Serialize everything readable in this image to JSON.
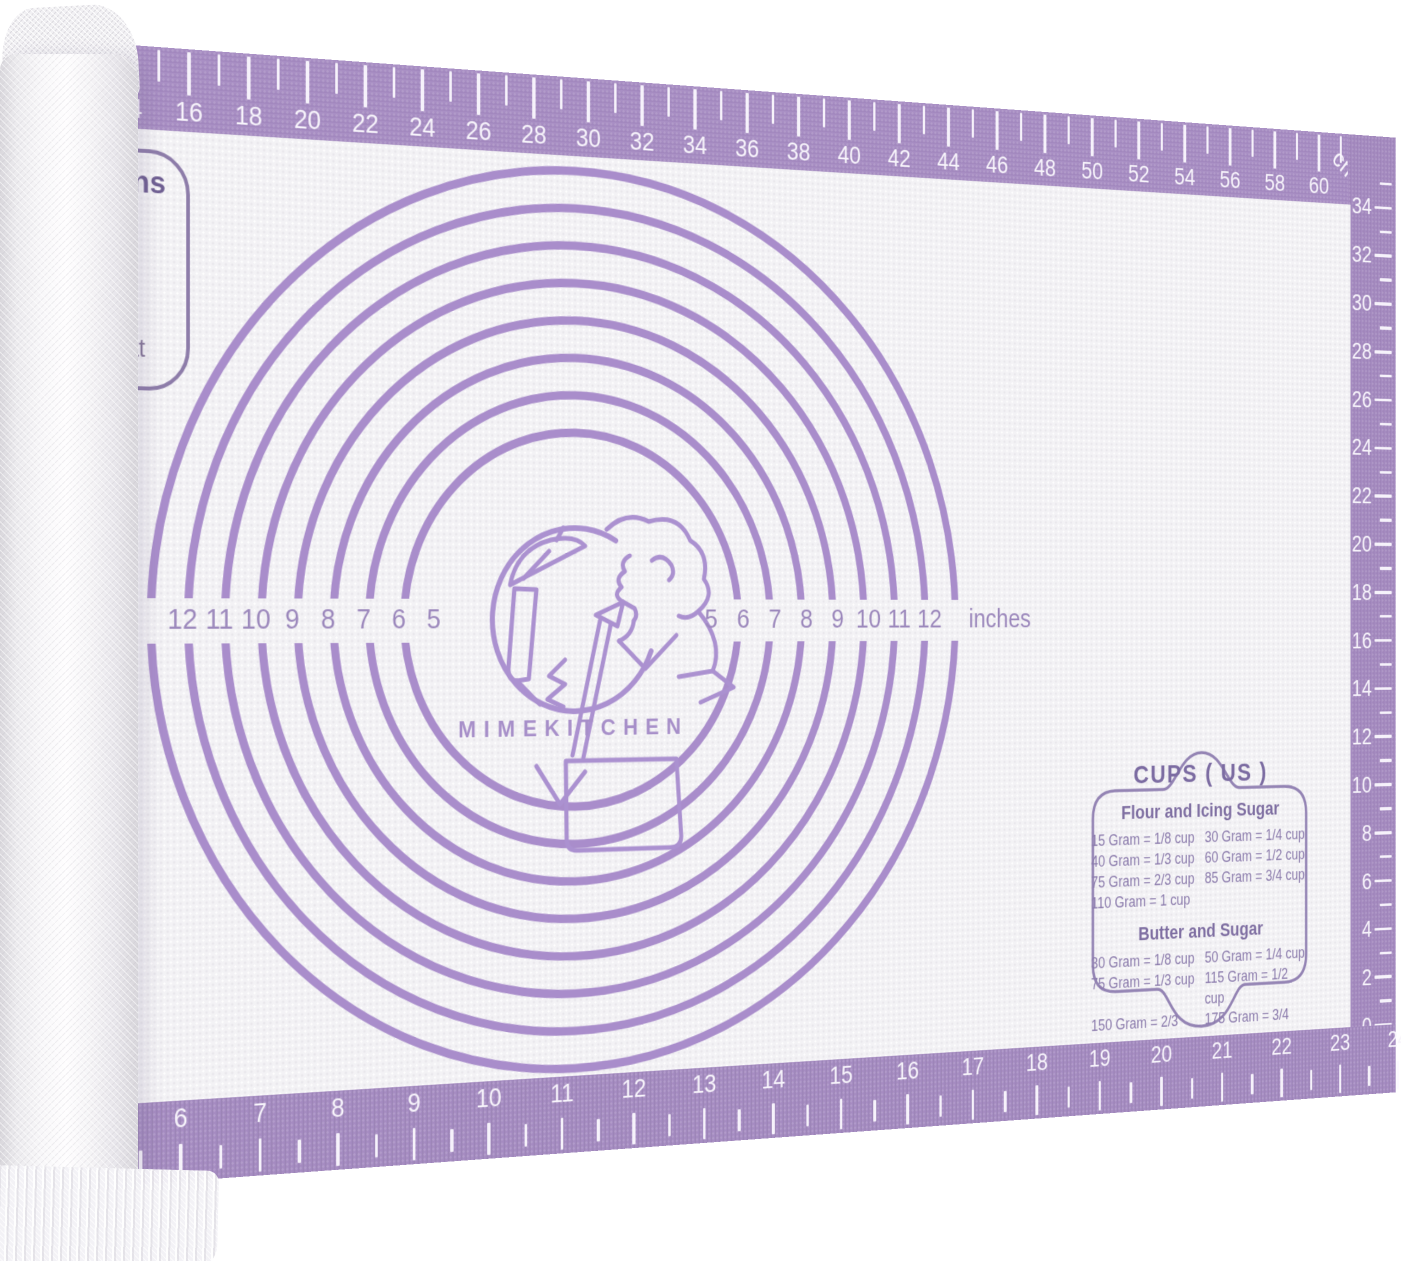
{
  "brand": {
    "logo_text": "MIMEKITCHEN"
  },
  "rulers": {
    "top": {
      "unit": "cm",
      "labels": [
        "14",
        "16",
        "18",
        "20",
        "22",
        "24",
        "26",
        "28",
        "30",
        "32",
        "34",
        "36",
        "38",
        "40",
        "42",
        "44",
        "46",
        "48",
        "50",
        "52",
        "54",
        "56",
        "58",
        "60"
      ]
    },
    "right": {
      "labels": [
        "34",
        "32",
        "30",
        "28",
        "26",
        "24",
        "22",
        "20",
        "18",
        "16",
        "14",
        "12",
        "10",
        "8",
        "6",
        "4",
        "2",
        "0"
      ]
    },
    "bottom": {
      "labels": [
        "6",
        "7",
        "8",
        "9",
        "10",
        "11",
        "12",
        "13",
        "14",
        "15",
        "16",
        "17",
        "18",
        "19",
        "20",
        "21",
        "22",
        "23",
        "24"
      ]
    }
  },
  "circle_guides": {
    "left_labels": [
      "12",
      "11",
      "10",
      "9",
      "8",
      "7",
      "6",
      "5"
    ],
    "right_labels": [
      "5",
      "6",
      "7",
      "8",
      "9",
      "10",
      "11",
      "12"
    ],
    "unit": "inches"
  },
  "instructions_box": {
    "partial_line_1": "ns",
    "partial_line_2": "nat"
  },
  "conversion_chart": {
    "title": "CUPS ( US )",
    "sections": [
      {
        "heading": "Flour and Icing Sugar",
        "rows": [
          [
            "15 Gram = 1/8 cup",
            "30 Gram = 1/4 cup"
          ],
          [
            "40 Gram = 1/3 cup",
            "60 Gram = 1/2 cup"
          ],
          [
            "75 Gram = 2/3 cup",
            "85 Gram = 3/4 cup"
          ],
          [
            "110 Gram =   1 cup",
            ""
          ]
        ]
      },
      {
        "heading": "Butter and Sugar",
        "rows": [
          [
            "30 Gram = 1/8 cup",
            "50 Gram = 1/4 cup"
          ],
          [
            "75 Gram = 1/3 cup",
            "115 Gram = 1/2 cup"
          ],
          [
            "150 Gram = 2/3 cup",
            "175 Gram = 3/4 cup"
          ],
          [
            "225 Gram =   1 cup",
            ""
          ]
        ]
      }
    ]
  },
  "colors": {
    "border_purple": "#a58bc1",
    "ring_purple": "#a98dcb",
    "chart_text_purple": "#8b7bac",
    "mat_base": "#f3f2f5"
  }
}
